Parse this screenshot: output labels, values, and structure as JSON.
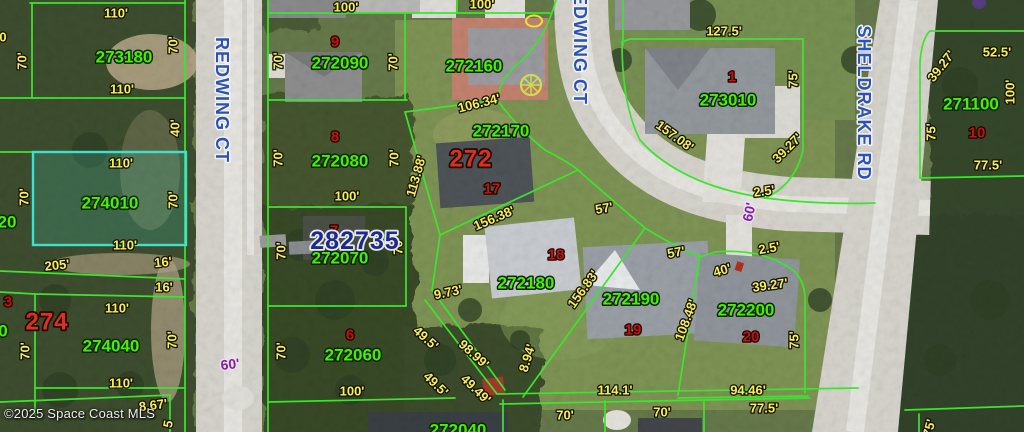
{
  "map": {
    "watermark": "©2025 Space Coast MLS",
    "listing_number": {
      "text": "282735",
      "x": 355,
      "y": 241
    },
    "highlighted_parcel": "274010",
    "streets": [
      {
        "text": "REDWING CT",
        "x": 222,
        "y": 100,
        "rotate": 90
      },
      {
        "text": "REDWING CT",
        "x": 580,
        "y": 42,
        "rotate": 90
      },
      {
        "text": "SHELDRAKE RD",
        "x": 864,
        "y": 103,
        "rotate": 90
      }
    ],
    "parcel_numbers": [
      {
        "text": "273180",
        "x": 124,
        "y": 57
      },
      {
        "text": "272090",
        "x": 340,
        "y": 63
      },
      {
        "text": "272160",
        "x": 474,
        "y": 66
      },
      {
        "text": "272170",
        "x": 501,
        "y": 131
      },
      {
        "text": "272080",
        "x": 340,
        "y": 161
      },
      {
        "text": "274010",
        "x": 110,
        "y": 203
      },
      {
        "text": "272070",
        "x": 340,
        "y": 258
      },
      {
        "text": "272060",
        "x": 353,
        "y": 355
      },
      {
        "text": "272180",
        "x": 526,
        "y": 283
      },
      {
        "text": "272190",
        "x": 631,
        "y": 299
      },
      {
        "text": "272200",
        "x": 746,
        "y": 310
      },
      {
        "text": "273010",
        "x": 728,
        "y": 100
      },
      {
        "text": "271100",
        "x": 971,
        "y": 104
      },
      {
        "text": "274040",
        "x": 111,
        "y": 346
      },
      {
        "text": "272040",
        "x": 458,
        "y": 430
      },
      {
        "text": "20",
        "x": 7,
        "y": 222
      },
      {
        "text": "0",
        "x": 3,
        "y": 331
      }
    ],
    "lot_numbers": [
      {
        "text": "9",
        "x": 335,
        "y": 42
      },
      {
        "text": "8",
        "x": 335,
        "y": 137
      },
      {
        "text": "7",
        "x": 334,
        "y": 231
      },
      {
        "text": "17",
        "x": 492,
        "y": 189
      },
      {
        "text": "18",
        "x": 556,
        "y": 255
      },
      {
        "text": "19",
        "x": 633,
        "y": 330
      },
      {
        "text": "20",
        "x": 751,
        "y": 337
      },
      {
        "text": "1",
        "x": 732,
        "y": 77
      },
      {
        "text": "10",
        "x": 977,
        "y": 133
      },
      {
        "text": "3",
        "x": 8,
        "y": 302
      },
      {
        "text": "6",
        "x": 350,
        "y": 335
      }
    ],
    "block_numbers": [
      {
        "text": "272",
        "x": 471,
        "y": 159
      },
      {
        "text": "274",
        "x": 47,
        "y": 322
      }
    ],
    "dimensions": [
      {
        "text": "110'",
        "x": 116,
        "y": 13,
        "rotate": 0
      },
      {
        "text": "70'",
        "x": 22,
        "y": 61,
        "rotate": -90
      },
      {
        "text": "70'",
        "x": 173,
        "y": 45,
        "rotate": -90
      },
      {
        "text": "0",
        "x": 3,
        "y": 37,
        "rotate": 0
      },
      {
        "text": "110'",
        "x": 122,
        "y": 89,
        "rotate": 0
      },
      {
        "text": "40'",
        "x": 175,
        "y": 128,
        "rotate": -90
      },
      {
        "text": "110'",
        "x": 121,
        "y": 163,
        "rotate": 0
      },
      {
        "text": "70'",
        "x": 24,
        "y": 197,
        "rotate": -90
      },
      {
        "text": "70'",
        "x": 173,
        "y": 200,
        "rotate": -90
      },
      {
        "text": "110'",
        "x": 125,
        "y": 245,
        "rotate": 0
      },
      {
        "text": "205'",
        "x": 57,
        "y": 265,
        "rotate": -6
      },
      {
        "text": "16'",
        "x": 163,
        "y": 262,
        "rotate": -6
      },
      {
        "text": "16'",
        "x": 164,
        "y": 287,
        "rotate": 0
      },
      {
        "text": "110'",
        "x": 117,
        "y": 308,
        "rotate": 0
      },
      {
        "text": "70'",
        "x": 25,
        "y": 351,
        "rotate": -90
      },
      {
        "text": "70'",
        "x": 172,
        "y": 340,
        "rotate": -90
      },
      {
        "text": "110'",
        "x": 121,
        "y": 383,
        "rotate": 0
      },
      {
        "text": "8.67'",
        "x": 153,
        "y": 405,
        "rotate": -7
      },
      {
        "text": "5",
        "x": 168,
        "y": 424,
        "rotate": -78
      },
      {
        "text": "100'",
        "x": 346,
        "y": 7,
        "rotate": 0
      },
      {
        "text": "100'",
        "x": 482,
        "y": 4,
        "rotate": 0
      },
      {
        "text": "70'",
        "x": 278,
        "y": 61,
        "rotate": -90
      },
      {
        "text": "70'",
        "x": 393,
        "y": 62,
        "rotate": -90
      },
      {
        "text": "106.34'",
        "x": 479,
        "y": 103,
        "rotate": -14
      },
      {
        "text": "70'",
        "x": 278,
        "y": 158,
        "rotate": -90
      },
      {
        "text": "70'",
        "x": 394,
        "y": 158,
        "rotate": -90
      },
      {
        "text": "113.88'",
        "x": 416,
        "y": 176,
        "rotate": -74
      },
      {
        "text": "100'",
        "x": 347,
        "y": 196,
        "rotate": 0
      },
      {
        "text": "70'",
        "x": 281,
        "y": 251,
        "rotate": -90
      },
      {
        "text": "70'",
        "x": 398,
        "y": 246,
        "rotate": -90
      },
      {
        "text": "156.38'",
        "x": 494,
        "y": 218,
        "rotate": -23
      },
      {
        "text": "70'",
        "x": 281,
        "y": 351,
        "rotate": -90
      },
      {
        "text": "100'",
        "x": 352,
        "y": 391,
        "rotate": 0
      },
      {
        "text": "9.73'",
        "x": 448,
        "y": 292,
        "rotate": -12
      },
      {
        "text": "49.5'",
        "x": 426,
        "y": 338,
        "rotate": 42
      },
      {
        "text": "49.5'",
        "x": 436,
        "y": 384,
        "rotate": 44
      },
      {
        "text": "49.49'",
        "x": 476,
        "y": 389,
        "rotate": 44
      },
      {
        "text": "98.99'",
        "x": 474,
        "y": 354,
        "rotate": 42
      },
      {
        "text": "8.94'",
        "x": 527,
        "y": 358,
        "rotate": -73
      },
      {
        "text": "156.83'",
        "x": 583,
        "y": 289,
        "rotate": -54
      },
      {
        "text": "114.1'",
        "x": 615,
        "y": 390,
        "rotate": 0
      },
      {
        "text": "70'",
        "x": 565,
        "y": 415,
        "rotate": 0
      },
      {
        "text": "70'",
        "x": 662,
        "y": 412,
        "rotate": 0
      },
      {
        "text": "57'",
        "x": 604,
        "y": 208,
        "rotate": -10
      },
      {
        "text": "57'",
        "x": 676,
        "y": 252,
        "rotate": -10
      },
      {
        "text": "127.5'",
        "x": 724,
        "y": 31,
        "rotate": 0
      },
      {
        "text": "157.08'",
        "x": 675,
        "y": 136,
        "rotate": 36
      },
      {
        "text": "75'",
        "x": 793,
        "y": 79,
        "rotate": -90
      },
      {
        "text": "39.27'",
        "x": 787,
        "y": 148,
        "rotate": -45
      },
      {
        "text": "2.5'",
        "x": 764,
        "y": 191,
        "rotate": -8
      },
      {
        "text": "2.5'",
        "x": 769,
        "y": 248,
        "rotate": -10
      },
      {
        "text": "40'",
        "x": 722,
        "y": 270,
        "rotate": -16
      },
      {
        "text": "39.27'",
        "x": 770,
        "y": 285,
        "rotate": -8
      },
      {
        "text": "108.48'",
        "x": 686,
        "y": 320,
        "rotate": -70
      },
      {
        "text": "75'",
        "x": 794,
        "y": 340,
        "rotate": -90
      },
      {
        "text": "94.46'",
        "x": 748,
        "y": 390,
        "rotate": 0
      },
      {
        "text": "77.5'",
        "x": 764,
        "y": 408,
        "rotate": 0
      },
      {
        "text": "52.5'",
        "x": 997,
        "y": 52,
        "rotate": 0
      },
      {
        "text": "39.27'",
        "x": 941,
        "y": 66,
        "rotate": -52
      },
      {
        "text": "100'",
        "x": 1010,
        "y": 92,
        "rotate": -90
      },
      {
        "text": "75'",
        "x": 931,
        "y": 132,
        "rotate": -90
      },
      {
        "text": "77.5'",
        "x": 988,
        "y": 165,
        "rotate": 0
      },
      {
        "text": "75'",
        "x": 929,
        "y": 428,
        "rotate": -75
      }
    ],
    "road_width_labels": [
      {
        "text": "60'",
        "x": 749,
        "y": 212,
        "rotate": -78
      },
      {
        "text": "60'",
        "x": 230,
        "y": 364,
        "rotate": -6
      }
    ]
  },
  "colors": {
    "parcel_line": "#3ce52c",
    "parcel_number": "#46f000",
    "lot_number": "#c01800",
    "block_number": "#d6341c",
    "dimension": "#f8ef5a",
    "street_name": "#2b52b8",
    "listing_number": "#1b2a8f",
    "highlight": "#3fe0cc",
    "road_width": "#7d22a0"
  }
}
